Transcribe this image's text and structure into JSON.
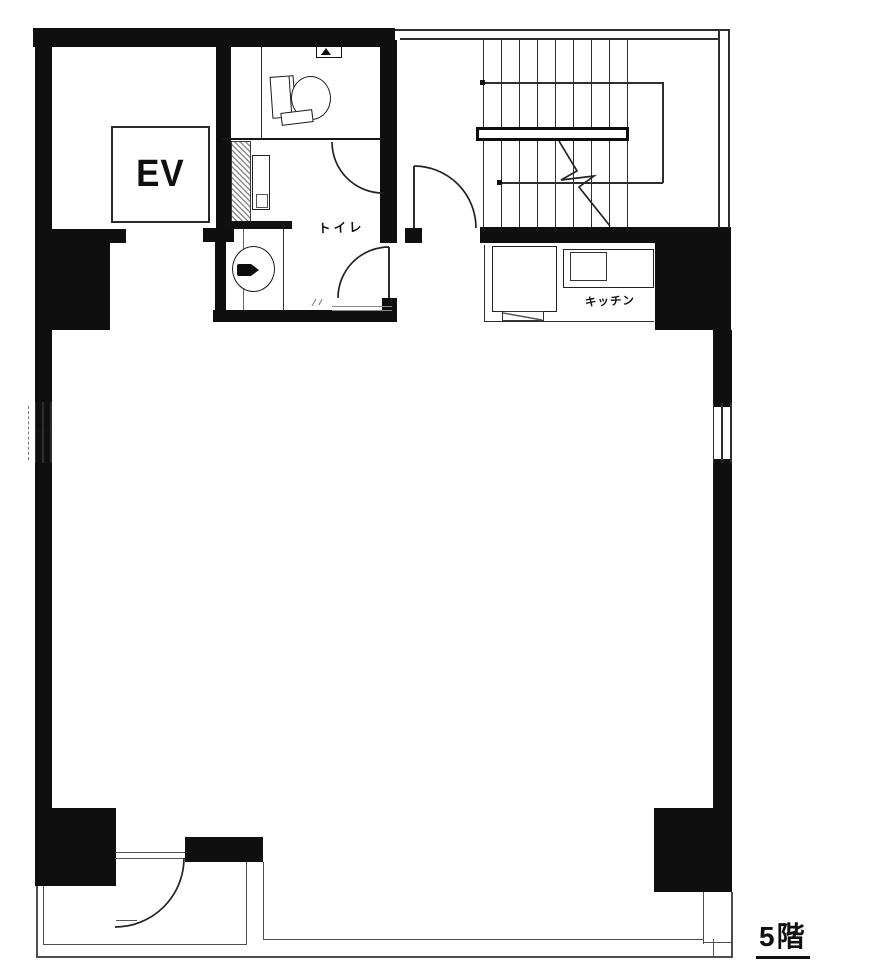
{
  "floor_plan": {
    "floor_label": "5階",
    "labels": {
      "elevator": "EV",
      "toilet": "トイレ",
      "kitchen": "キッチン"
    },
    "colors": {
      "wall": "#0f0f0f",
      "line": "#2e2e2e",
      "balcony_line": "#4d4d4d",
      "background": "#ffffff"
    }
  }
}
